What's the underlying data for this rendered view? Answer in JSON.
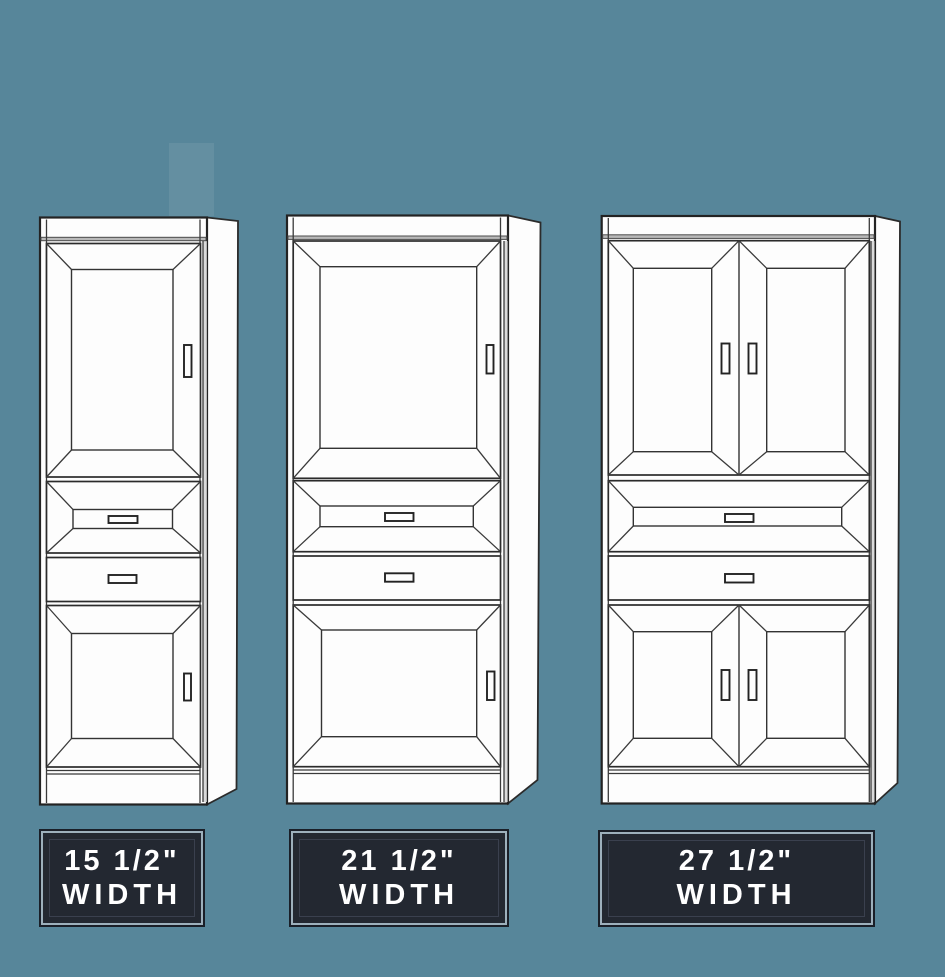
{
  "canvas": {
    "width": 945,
    "height": 977,
    "background": "#57869A"
  },
  "palette": {
    "line": "#2B2B2B",
    "cabinet_fill": "#FDFDFD",
    "crown_gray": "#B9B9B9",
    "stile_shade": "#DADADA",
    "label_bg": "#232831",
    "label_border_outer": "#1A1F28",
    "label_border_inner": "#9DB0BC",
    "label_text": "#FFFFFF"
  },
  "cabinets": [
    {
      "id": "tower-15",
      "label": {
        "line1": "15 1/2\"",
        "line2": "WIDTH"
      },
      "features": {
        "upper_doors": 1,
        "drawers": 2,
        "lower_doors": 1
      }
    },
    {
      "id": "tower-21",
      "label": {
        "line1": "21 1/2\"",
        "line2": "WIDTH"
      },
      "features": {
        "upper_doors": 1,
        "drawers": 2,
        "lower_doors": 1
      }
    },
    {
      "id": "tower-27",
      "label": {
        "line1": "27 1/2\"",
        "line2": "WIDTH"
      },
      "features": {
        "upper_doors": 2,
        "drawers": 2,
        "lower_doors": 2
      }
    }
  ]
}
